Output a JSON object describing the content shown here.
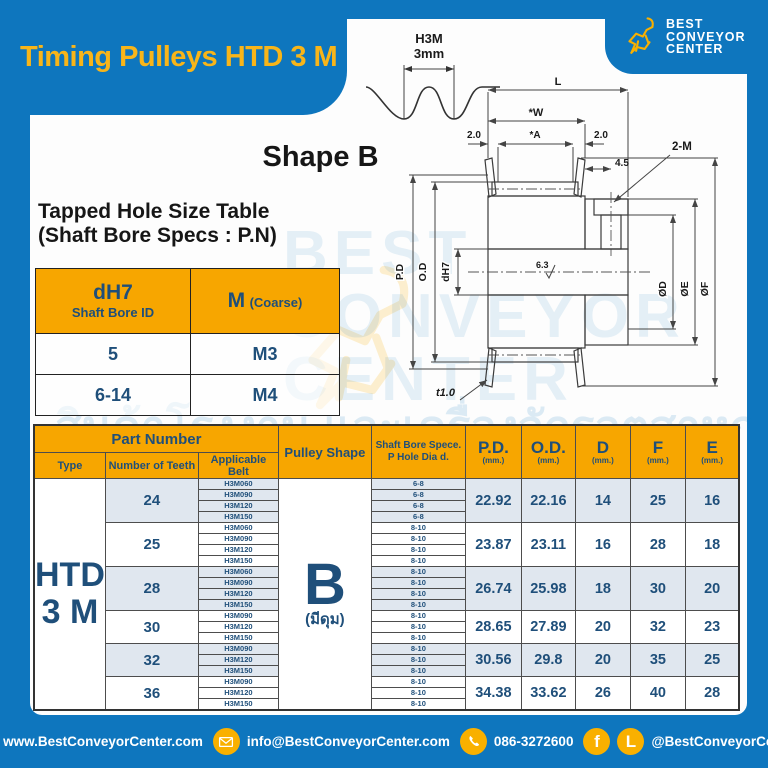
{
  "page": {
    "title": "Timing Pulleys HTD 3 M",
    "shape_heading": "Shape B"
  },
  "logo": {
    "line1": "BEST",
    "line2": "CONVEYOR",
    "line3": "CENTER"
  },
  "belt_profile": {
    "name": "H3M",
    "pitch": "3mm"
  },
  "tapped_hole_table": {
    "heading_line1": "Tapped Hole Size Table",
    "heading_line2": "(Shaft Bore Specs : P.N)",
    "col1_title": "dH7",
    "col1_sub": "Shaft Bore ID",
    "col2_title": "M",
    "col2_sub": "(Coarse)",
    "rows": [
      {
        "bore": "5",
        "thread": "M3"
      },
      {
        "bore": "6-14",
        "thread": "M4"
      }
    ]
  },
  "drawing": {
    "L": "L",
    "W": "*W",
    "A": "*A",
    "left_offset": "2.0",
    "right_offset": "2.0",
    "hole_offset": "4.5",
    "tap": "2-M",
    "pd": "P.D",
    "od": "O.D",
    "bore": "dH7",
    "finish": "6.3",
    "dD": "ØD",
    "dE": "ØE",
    "dF": "ØF",
    "flange_t": "t1.0"
  },
  "main_table": {
    "header": {
      "part_number": "Part Number",
      "type": "Type",
      "teeth": "Number of Teeth",
      "belt": "Applicable Belt",
      "shape": "Pulley Shape",
      "bore_line1": "Shaft Bore Spece.",
      "bore_line2": "P Hole Dia d.",
      "pd": "P.D.",
      "od": "O.D.",
      "d": "D",
      "f": "F",
      "e": "E",
      "unit": "(mm.)"
    },
    "type_value": {
      "line1": "HTD",
      "line2": "3 M"
    },
    "shape_value": {
      "letter": "B",
      "sub": "(มีดุม)"
    },
    "groups": [
      {
        "teeth": "24",
        "belts": [
          "H3M060",
          "H3M090",
          "H3M120",
          "H3M150"
        ],
        "bores": [
          "6-8",
          "6-8",
          "6-8",
          "6-8"
        ],
        "pd": "22.92",
        "od": "22.16",
        "d": "14",
        "f": "25",
        "e": "16"
      },
      {
        "teeth": "25",
        "belts": [
          "H3M060",
          "H3M090",
          "H3M120",
          "H3M150"
        ],
        "bores": [
          "8-10",
          "8-10",
          "8-10",
          "8-10"
        ],
        "pd": "23.87",
        "od": "23.11",
        "d": "16",
        "f": "28",
        "e": "18"
      },
      {
        "teeth": "28",
        "belts": [
          "H3M060",
          "H3M090",
          "H3M120",
          "H3M150"
        ],
        "bores": [
          "8-10",
          "8-10",
          "8-10",
          "8-10"
        ],
        "pd": "26.74",
        "od": "25.98",
        "d": "18",
        "f": "30",
        "e": "20"
      },
      {
        "teeth": "30",
        "belts": [
          "H3M090",
          "H3M120",
          "H3M150"
        ],
        "bores": [
          "8-10",
          "8-10",
          "8-10"
        ],
        "pd": "28.65",
        "od": "27.89",
        "d": "20",
        "f": "32",
        "e": "23"
      },
      {
        "teeth": "32",
        "belts": [
          "H3M090",
          "H3M120",
          "H3M150"
        ],
        "bores": [
          "8-10",
          "8-10",
          "8-10"
        ],
        "pd": "30.56",
        "od": "29.8",
        "d": "20",
        "f": "35",
        "e": "25"
      },
      {
        "teeth": "36",
        "belts": [
          "H3M090",
          "H3M120",
          "H3M150"
        ],
        "bores": [
          "8-10",
          "8-10",
          "8-10"
        ],
        "pd": "34.38",
        "od": "33.62",
        "d": "26",
        "f": "40",
        "e": "28"
      }
    ]
  },
  "watermark": {
    "ghost_line1": "BEST",
    "ghost_line2": "CONVEYOR",
    "ghost_line3": "CENTER",
    "thai": "สินค้าโรงงาน และเครื่องจักรอุตสาหกรรม"
  },
  "footer": {
    "website": "www.BestConveyorCenter.com",
    "email": "info@BestConveyorCenter.com",
    "phone": "086-3272600",
    "social": "@BestConveyorCenter",
    "facebook_glyph": "f",
    "line_glyph": "L"
  },
  "colors": {
    "brand_blue": "#0E76BE",
    "brand_yellow": "#F8B519",
    "header_orange": "#F7A600",
    "navy_text": "#1F4F7A",
    "light_row": "#E0E7EF"
  }
}
